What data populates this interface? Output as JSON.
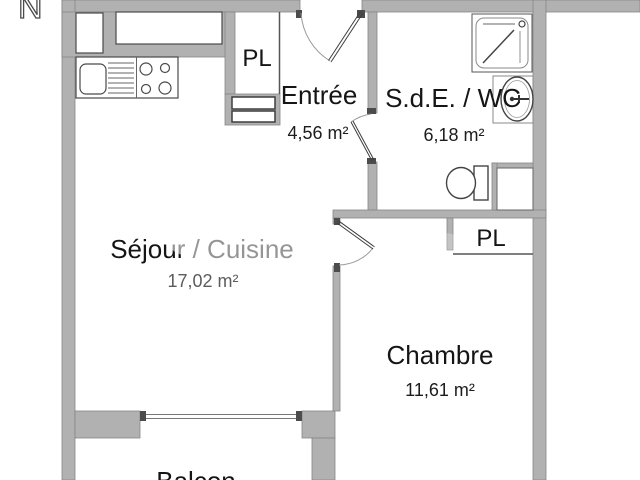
{
  "plan": {
    "title": "Apartment floor plan",
    "compass": "N",
    "rooms": [
      {
        "id": "entree",
        "label": "Entrée",
        "area": "4,56 m²"
      },
      {
        "id": "sde-wc",
        "label": "S.d.E. / WC",
        "area": "6,18 m²"
      },
      {
        "id": "sejour-cuisine",
        "label": "Séjour / Cuisine",
        "area": "17,02 m²"
      },
      {
        "id": "chambre",
        "label": "Chambre",
        "area": "11,61 m²"
      },
      {
        "id": "balcon",
        "label": "Balcon",
        "area": ""
      }
    ],
    "closets": [
      {
        "id": "pl-entree",
        "label": "PL"
      },
      {
        "id": "pl-chambre",
        "label": "PL"
      }
    ],
    "fixtures": [
      "wall-cabinets",
      "kitchen-sink",
      "drainer",
      "cooktop-4-burners",
      "shower",
      "washbasin",
      "toilet",
      "duct-niche",
      "balcony-sliding-window"
    ],
    "doors": [
      "entrance-door",
      "bathroom-door",
      "bedroom-door"
    ],
    "colors": {
      "background": "#ffffff",
      "wall": "#b1b1b1",
      "wall_edge": "#868686",
      "dark_line": "#4a4a4a",
      "light_line": "#9a9a9a",
      "text": "#151515"
    }
  }
}
